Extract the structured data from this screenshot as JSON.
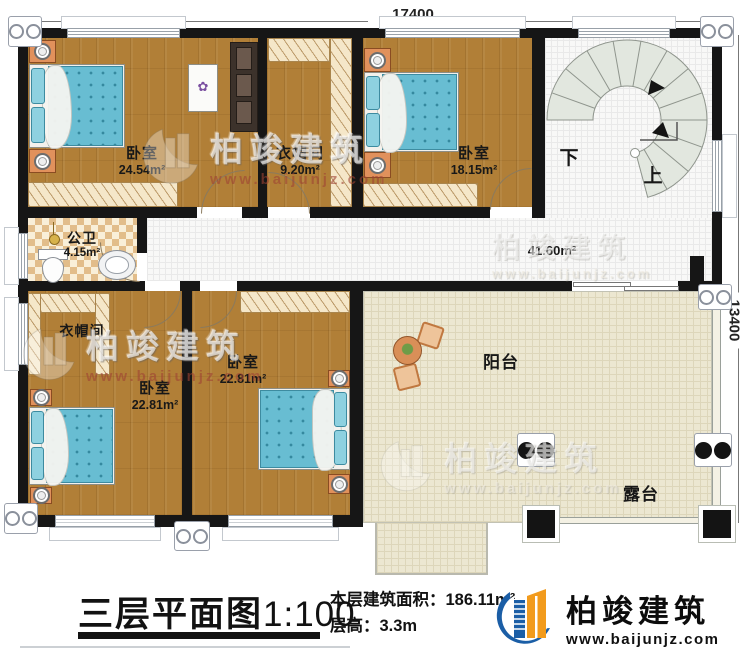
{
  "dimensions": {
    "top": "17400",
    "right": "13400"
  },
  "rooms": {
    "bedroom_tl": {
      "name": "卧室",
      "area": "24.54m²"
    },
    "closet_top": {
      "name": "衣帽间",
      "area": "9.20m²"
    },
    "bedroom_tr": {
      "name": "卧室",
      "area": "18.15m²"
    },
    "bathroom": {
      "name": "公卫",
      "area": "4.15m²"
    },
    "hall": {
      "area": "41.60m²"
    },
    "closet_bl": {
      "name": "衣帽间"
    },
    "bedroom_bl": {
      "name": "卧室",
      "area": "22.81m²"
    },
    "bedroom_bm": {
      "name": "卧室",
      "area": "22.81m²"
    },
    "balcony": {
      "name": "阳台"
    },
    "terrace": {
      "name": "露台"
    },
    "stairs": {
      "down": "下",
      "up": "上"
    }
  },
  "footer": {
    "title": "三层平面图",
    "scale": "1:100",
    "area_label": "本层建筑面积：",
    "area_value": "186.11m²",
    "height_label": "层高：",
    "height_value": "3.3m"
  },
  "logo": {
    "name": "柏竣建筑",
    "url": "www.baijunjz.com"
  },
  "watermark": {
    "name": "柏竣建筑",
    "url": "www.baijunjz.com"
  },
  "colors": {
    "wall": "#161616",
    "wood": "#b17f37",
    "bed": "#68bdd2",
    "terrace": "#ece7d1",
    "logo_blue": "#1b5ea6",
    "logo_orange": "#f29b1d"
  }
}
